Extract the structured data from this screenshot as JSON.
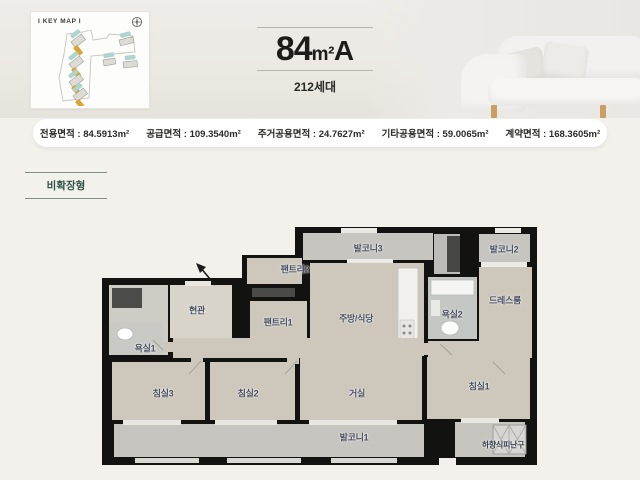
{
  "header": {
    "keymap_title": "I KEY MAP I",
    "unit_area": "84",
    "unit_area_suffix": "m²",
    "unit_type": "A",
    "households": "212세대"
  },
  "stats": {
    "items": [
      {
        "text": "전용면적 : 84.5913m²"
      },
      {
        "text": "공급면적 : 109.3540m²"
      },
      {
        "text": "주거공용면적 : 24.7627m²"
      },
      {
        "text": "기타공용면적 : 59.0065m²"
      },
      {
        "text": "계약면적 : 168.3605m²"
      }
    ]
  },
  "badge": {
    "label": "비확장형"
  },
  "plan": {
    "rooms": [
      {
        "label": "발코니3"
      },
      {
        "label": "발코니2"
      },
      {
        "label": "팬트리2"
      },
      {
        "label": "현관"
      },
      {
        "label": "팬트리1"
      },
      {
        "label": "주방/식당"
      },
      {
        "label": "욕실2"
      },
      {
        "label": "드레스룸"
      },
      {
        "label": "욕실1"
      },
      {
        "label": "침실3"
      },
      {
        "label": "침실2"
      },
      {
        "label": "거실"
      },
      {
        "label": "침실1"
      },
      {
        "label": "발코니1"
      },
      {
        "label": "하향식피난구"
      }
    ]
  },
  "colors": {
    "wall": "#121210",
    "room_fill": "#cdc8bb",
    "balcony_fill": "#c6c5c0",
    "accent_teal": "#2f5249",
    "keymap_highlight": "#d9a431",
    "page_bg": "#f2f1ec"
  }
}
